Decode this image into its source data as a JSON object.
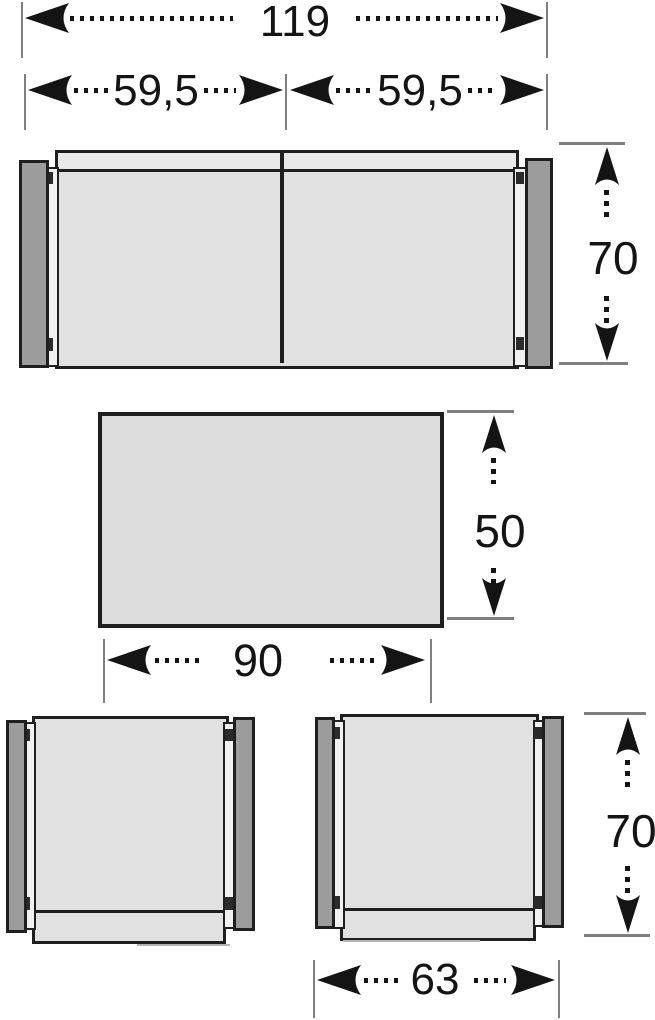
{
  "furniture": {
    "sofa": {
      "total_width": "119",
      "module_widths": [
        "59,5",
        "59,5"
      ],
      "depth": "70"
    },
    "table": {
      "width": "90",
      "depth": "50"
    },
    "armchair": {
      "width": "63",
      "depth": "70"
    }
  },
  "colors": {
    "outline": "#1f1f1f",
    "seat_fill": "#e1e1e1",
    "band_fill": "#e9e9e9",
    "armrest_fill": "#9c9c9c",
    "rail_fill": "#f1f1f1",
    "table_fill": "#dcdcdc",
    "ext_line": "#7f7f7f",
    "ink": "#141414",
    "bg": "#ffffff",
    "shadow_line": "#b3b3b3"
  }
}
